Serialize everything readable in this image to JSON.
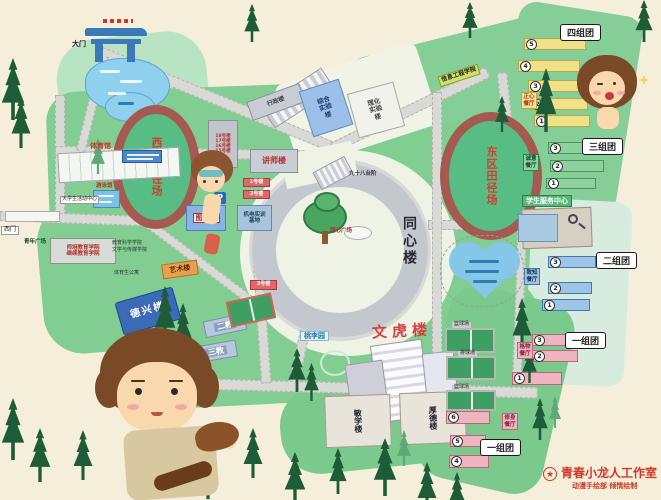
{
  "gates": {
    "main": "大门",
    "west": "西门"
  },
  "squares": {
    "youth": "青年广场",
    "tongxin": "同心广场"
  },
  "tracks": {
    "west": "西区田径场",
    "east": "东区田径场"
  },
  "center": {
    "building": "同心楼",
    "steps": "九十八台阶"
  },
  "west": {
    "gym": "体育馆",
    "pool": "游泳馆",
    "activity": "大学生活动中心",
    "college_a": "师培教育学院",
    "college_b": "继续教育学院",
    "college_c": "教育科学学院",
    "college_d": "文学与传媒学院",
    "sports_dorm": "体育生公寓",
    "art": "艺术楼",
    "dexing": "德兴楼",
    "teach2": "二教",
    "teach3": "三教"
  },
  "north": {
    "admin": "行政楼",
    "lab_a": "综合实验楼",
    "lab_b": "理化实验楼",
    "info_college": "信息工程学院",
    "lecturer": "讲师楼",
    "library": "图书馆",
    "parking": "P",
    "no1": "1号楼",
    "no2": "2号楼",
    "no3": "3号楼",
    "training": "机电实训基地",
    "rows": [
      "18号楼",
      "17号楼",
      "16号楼",
      "15号楼"
    ]
  },
  "south": {
    "taoli": "桃李园",
    "wenhu": "文虎楼",
    "minxue": "敏学楼",
    "houde": "厚德楼"
  },
  "east": {
    "service_center": "学生服务中心",
    "court1": "篮球场",
    "court2": "排球场",
    "court3": "篮球场"
  },
  "groups": {
    "four": {
      "label": "四组团",
      "canteen": "正心餐厅",
      "nums": [
        "5",
        "4",
        "3",
        "2",
        "1"
      ]
    },
    "three": {
      "label": "三组团",
      "canteen": "诚意餐厅",
      "nums": [
        "3",
        "2",
        "1"
      ]
    },
    "two": {
      "label": "二组团",
      "canteen": "致知餐厅",
      "nums": [
        "3",
        "2",
        "1"
      ]
    },
    "one_a": {
      "label": "一组团",
      "canteen": "格物餐厅",
      "nums": [
        "3",
        "2",
        "1"
      ]
    },
    "one_b": {
      "label": "一组团",
      "canteen": "修身餐厅",
      "nums": [
        "6",
        "5",
        "4"
      ]
    }
  },
  "credit": {
    "studio": "青春小龙人工作室",
    "dept": "动漫手绘部 倾情绘制"
  },
  "colors": {
    "background": "#f4eeda",
    "campus_green": "#82cd92",
    "road_grey": "#d9d9d6",
    "track_ring": "#a45a50",
    "water_blue": "#8fd0ee",
    "credit_red": "#d03828"
  }
}
